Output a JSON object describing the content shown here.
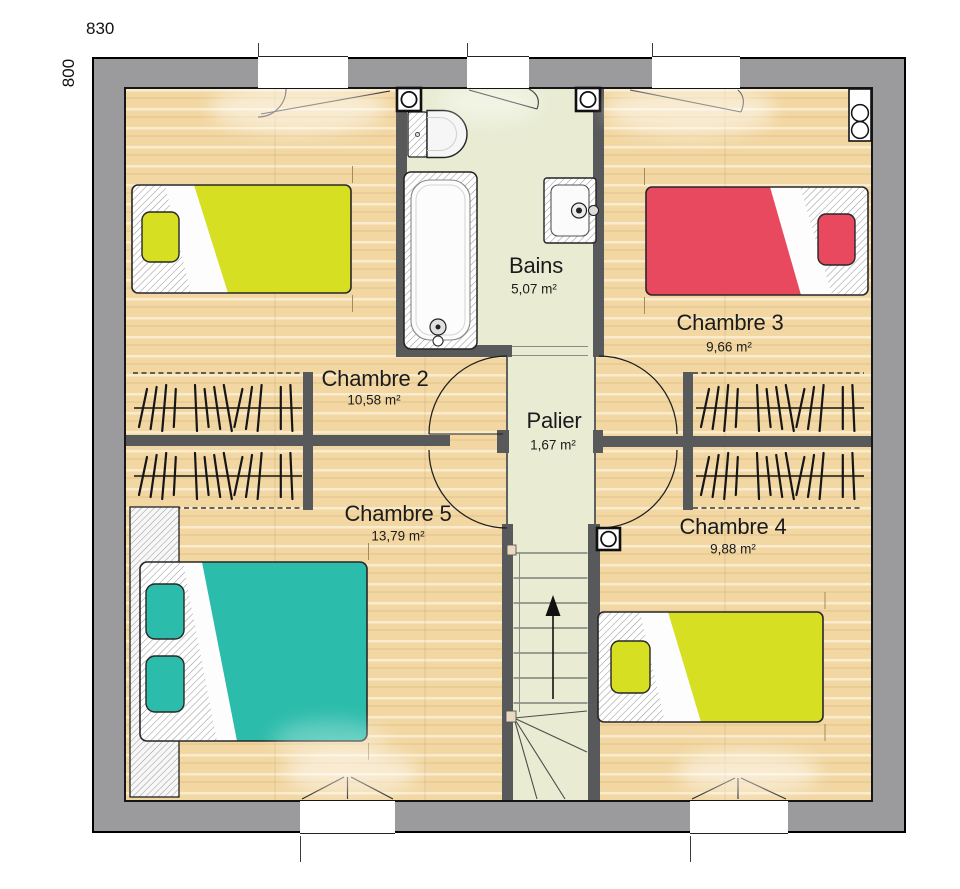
{
  "plan_title": "Floor plan — upper storey",
  "dimensions": {
    "width_label": "830",
    "height_label": "800"
  },
  "rooms": [
    {
      "id": "chambre-2",
      "name": "Chambre 2",
      "area": "10,58 m²"
    },
    {
      "id": "chambre-3",
      "name": "Chambre 3",
      "area": "9,66 m²"
    },
    {
      "id": "chambre-4",
      "name": "Chambre 4",
      "area": "9,88 m²"
    },
    {
      "id": "chambre-5",
      "name": "Chambre 5",
      "area": "13,79 m²"
    },
    {
      "id": "bains",
      "name": "Bains",
      "area": "5,07 m²"
    },
    {
      "id": "palier",
      "name": "Palier",
      "area": "1,67 m²"
    }
  ],
  "fixtures": [
    "bathtub",
    "toilet",
    "washbasin",
    "single-bed",
    "single-bed",
    "single-bed-double",
    "wardrobe",
    "hanging-rails",
    "staircase-up-arrow",
    "vent",
    "vent",
    "vent",
    "flue"
  ],
  "colors": {
    "wall": "#9b9b9d",
    "partition": "#58595b",
    "wood": "#f2d7a2",
    "corridor": "#e9ecd3",
    "bed_yellow": "#d7df23",
    "bed_red": "#e8495e",
    "bed_teal": "#2cbcab",
    "line": "#1f1f1f"
  }
}
